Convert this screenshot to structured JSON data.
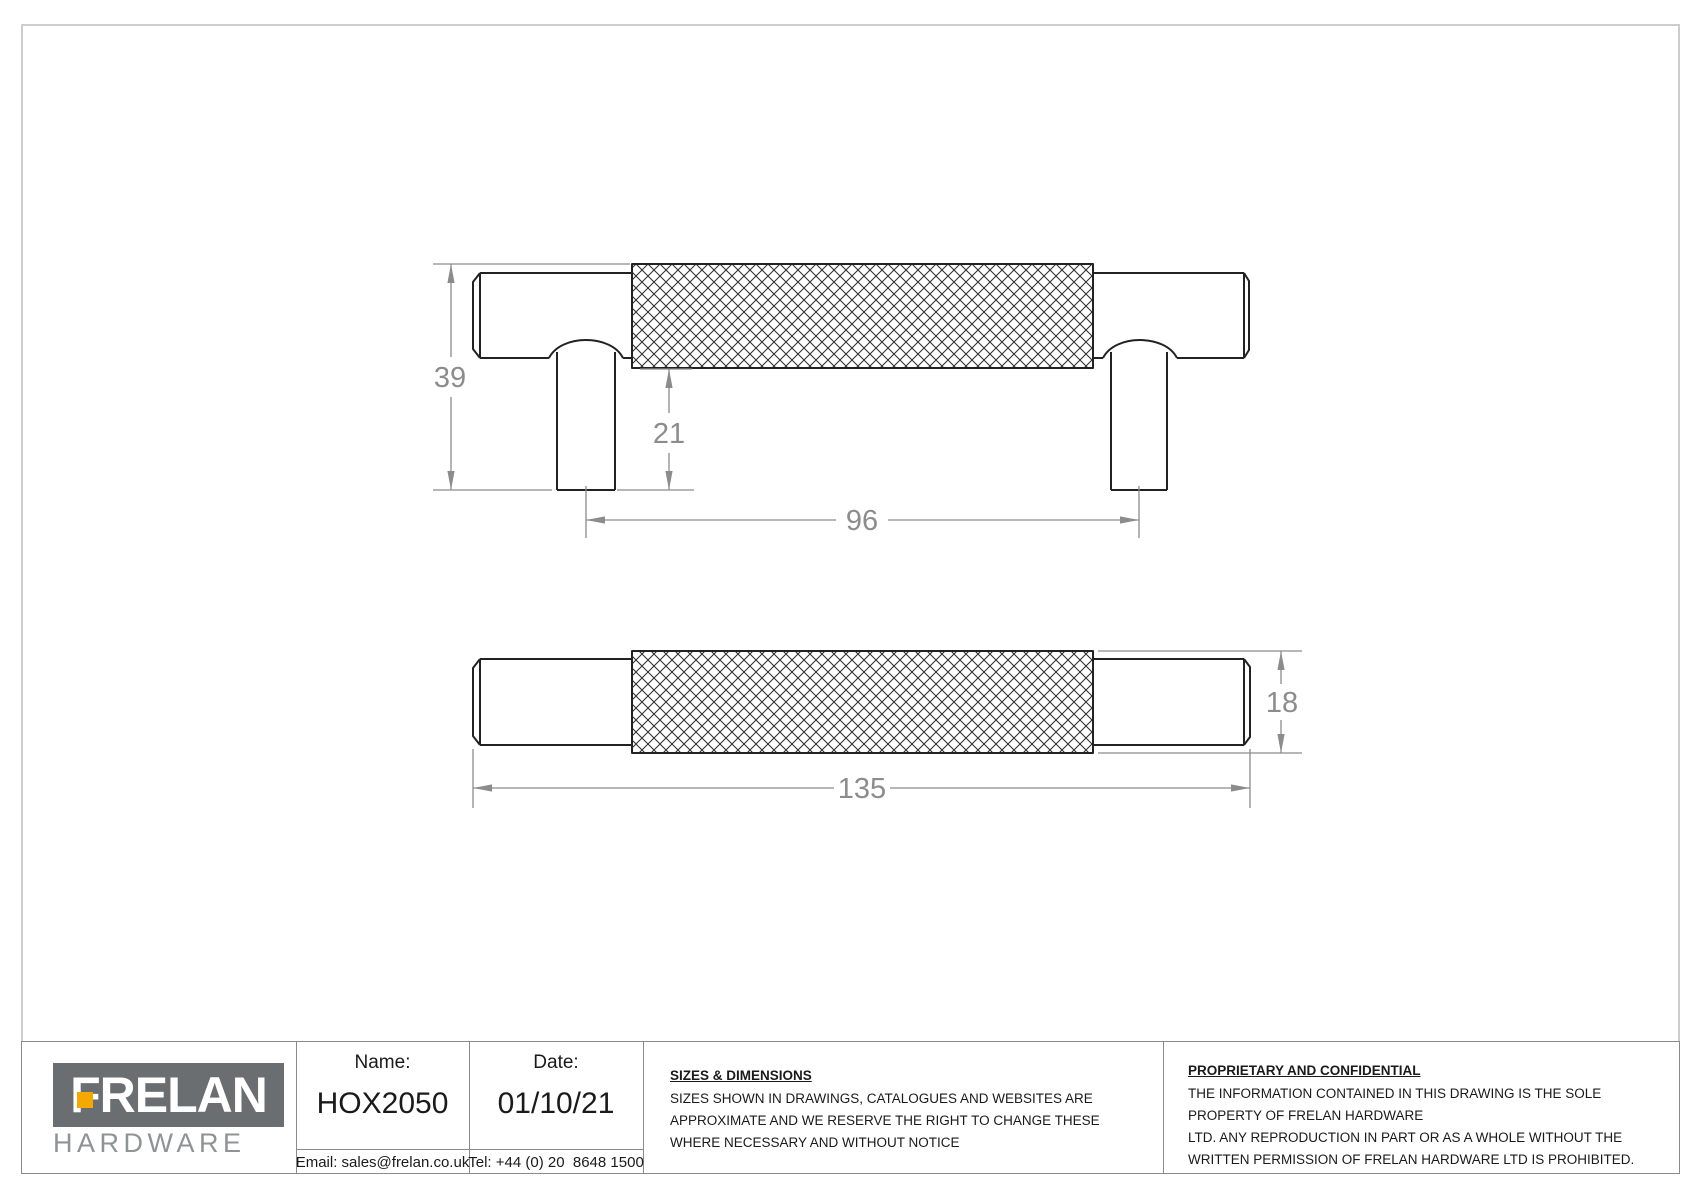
{
  "drawing": {
    "dims": {
      "overall_height": "39",
      "post_height": "21",
      "fixing_centres": "96",
      "overall_length": "135",
      "diameter": "18"
    }
  },
  "title_block": {
    "logo": {
      "brand": "FRELAN",
      "subtitle": "HARDWARE"
    },
    "name_label": "Name:",
    "name_value": "HOX2050",
    "date_label": "Date:",
    "date_value": "01/10/21",
    "email": "Email: sales@frelan.co.uk",
    "tel": "Tel: +44 (0) 20  8648 1500",
    "sizes": {
      "heading": "SIZES & DIMENSIONS",
      "body": "SIZES SHOWN IN DRAWINGS, CATALOGUES AND WEBSITES ARE APPROXIMATE AND WE RESERVE THE RIGHT TO CHANGE THESE WHERE NECESSARY AND WITHOUT NOTICE"
    },
    "proprietary": {
      "heading": "PROPRIETARY AND CONFIDENTIAL",
      "body_line1": "THE INFORMATION CONTAINED IN THIS DRAWING IS THE SOLE PROPERTY OF FRELAN HARDWARE",
      "body_line2": "LTD. ANY REPRODUCTION IN PART OR AS A WHOLE WITHOUT THE WRITTEN PERMISSION OF FRELAN HARDWARE LTD IS PROHIBITED."
    }
  },
  "colors": {
    "outline": "#222222",
    "dimension": "#8c8c8c",
    "logo_gray": "#6a6e70",
    "logo_orange": "#f5a800",
    "border_gray": "#cdcdcd"
  }
}
